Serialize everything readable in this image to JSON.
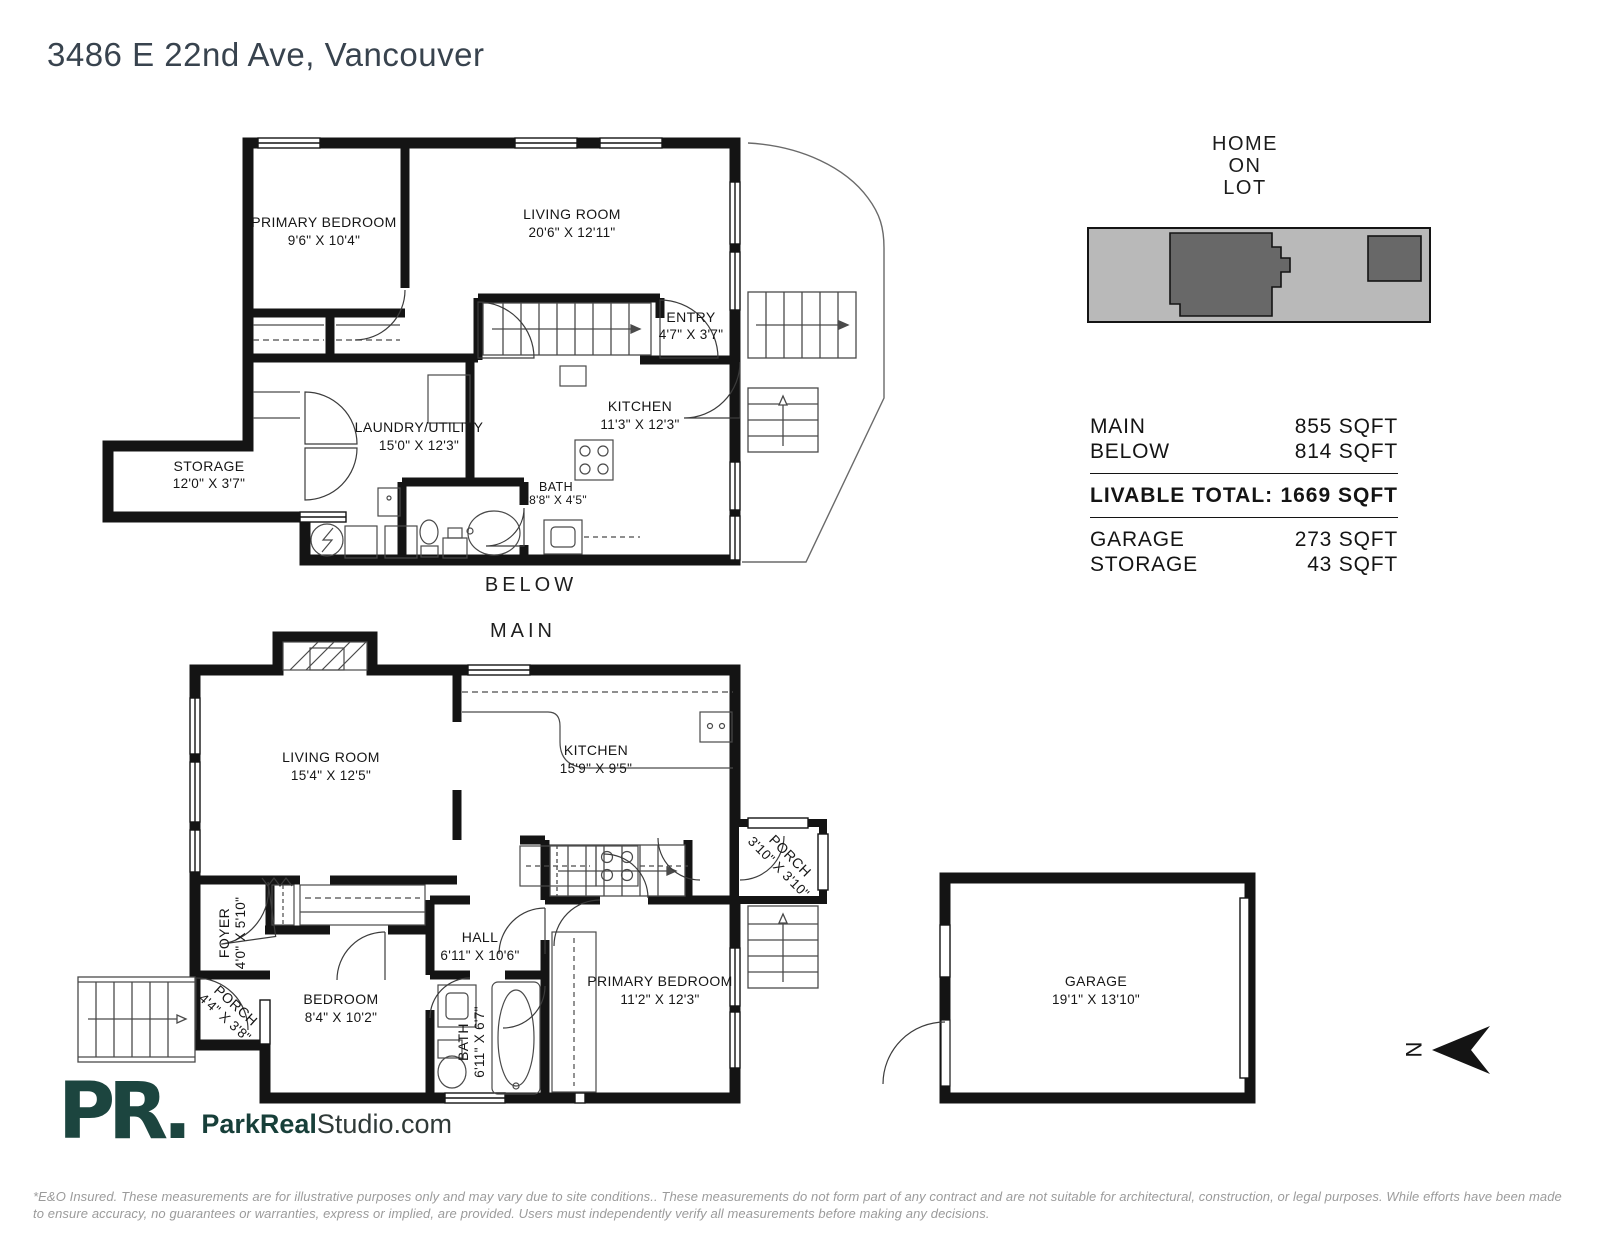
{
  "page": {
    "title": "3486 E 22nd Ave, Vancouver",
    "logo_mark": "PR.",
    "site_bold": "ParkReal",
    "site_rest": "Studio.com",
    "disclaimer": "*E&O Insured. These measurements are for illustrative purposes only and may vary due to site conditions.. These measurements do not form part of any contract and are not suitable for architectural, construction, or legal purposes. While efforts have been made to ensure accuracy, no guarantees or warranties, express or implied, are provided. Users must independently verify all measurements before making any decisions."
  },
  "lot": {
    "title_lines": [
      "HOME",
      "ON",
      "LOT"
    ]
  },
  "areas": {
    "rows": [
      {
        "label": "MAIN",
        "value": "855 SQFT"
      },
      {
        "label": "BELOW",
        "value": "814 SQFT"
      }
    ],
    "total": {
      "label": "LIVABLE TOTAL:",
      "value": "1669 SQFT"
    },
    "extra": [
      {
        "label": "GARAGE",
        "value": "273 SQFT"
      },
      {
        "label": "STORAGE",
        "value": "43 SQFT"
      }
    ]
  },
  "compass": {
    "label": "N"
  },
  "floors": {
    "below": {
      "label": "BELOW",
      "rooms": {
        "primary_bedroom": {
          "name": "PRIMARY BEDROOM",
          "dims": "9'6\" X 10'4\""
        },
        "living_room": {
          "name": "LIVING ROOM",
          "dims": "20'6\" X 12'11\""
        },
        "entry": {
          "name": "ENTRY",
          "dims": "4'7\" X 3'7\""
        },
        "kitchen": {
          "name": "KITCHEN",
          "dims": "11'3\" X 12'3\""
        },
        "laundry": {
          "name": "LAUNDRY/UTILITY",
          "dims": "15'0\" X 12'3\""
        },
        "storage": {
          "name": "STORAGE",
          "dims": "12'0\" X 3'7\""
        },
        "bath": {
          "name": "BATH",
          "dims": "8'8\" X 4'5\""
        }
      }
    },
    "main": {
      "label": "MAIN",
      "rooms": {
        "living_room": {
          "name": "LIVING ROOM",
          "dims": "15'4\" X 12'5\""
        },
        "kitchen": {
          "name": "KITCHEN",
          "dims": "15'9\" X 9'5\""
        },
        "porch_rear": {
          "name": "PORCH",
          "dims": "3'10\" X 3'10\""
        },
        "foyer": {
          "name": "FOYER",
          "dims": "4'0\" X 5'10\""
        },
        "porch_front": {
          "name": "PORCH",
          "dims": "4'4\" X 3'8\""
        },
        "bedroom": {
          "name": "BEDROOM",
          "dims": "8'4\" X 10'2\""
        },
        "hall": {
          "name": "HALL",
          "dims": "6'11\" X 10'6\""
        },
        "bath": {
          "name": "BATH",
          "dims": "6'11\" X 6'7\""
        },
        "primary_bedroom": {
          "name": "PRIMARY BEDROOM",
          "dims": "11'2\" X 12'3\""
        }
      }
    },
    "garage": {
      "rooms": {
        "garage": {
          "name": "GARAGE",
          "dims": "19'1\" X 13'10\""
        }
      }
    }
  },
  "colors": {
    "walls": "#141414",
    "title": "#38434e",
    "logo_teal": "#1c453f",
    "lot_ground": "#b9b9b9",
    "lot_building": "#686868",
    "disclaimer_gray": "#9b9b9b"
  }
}
